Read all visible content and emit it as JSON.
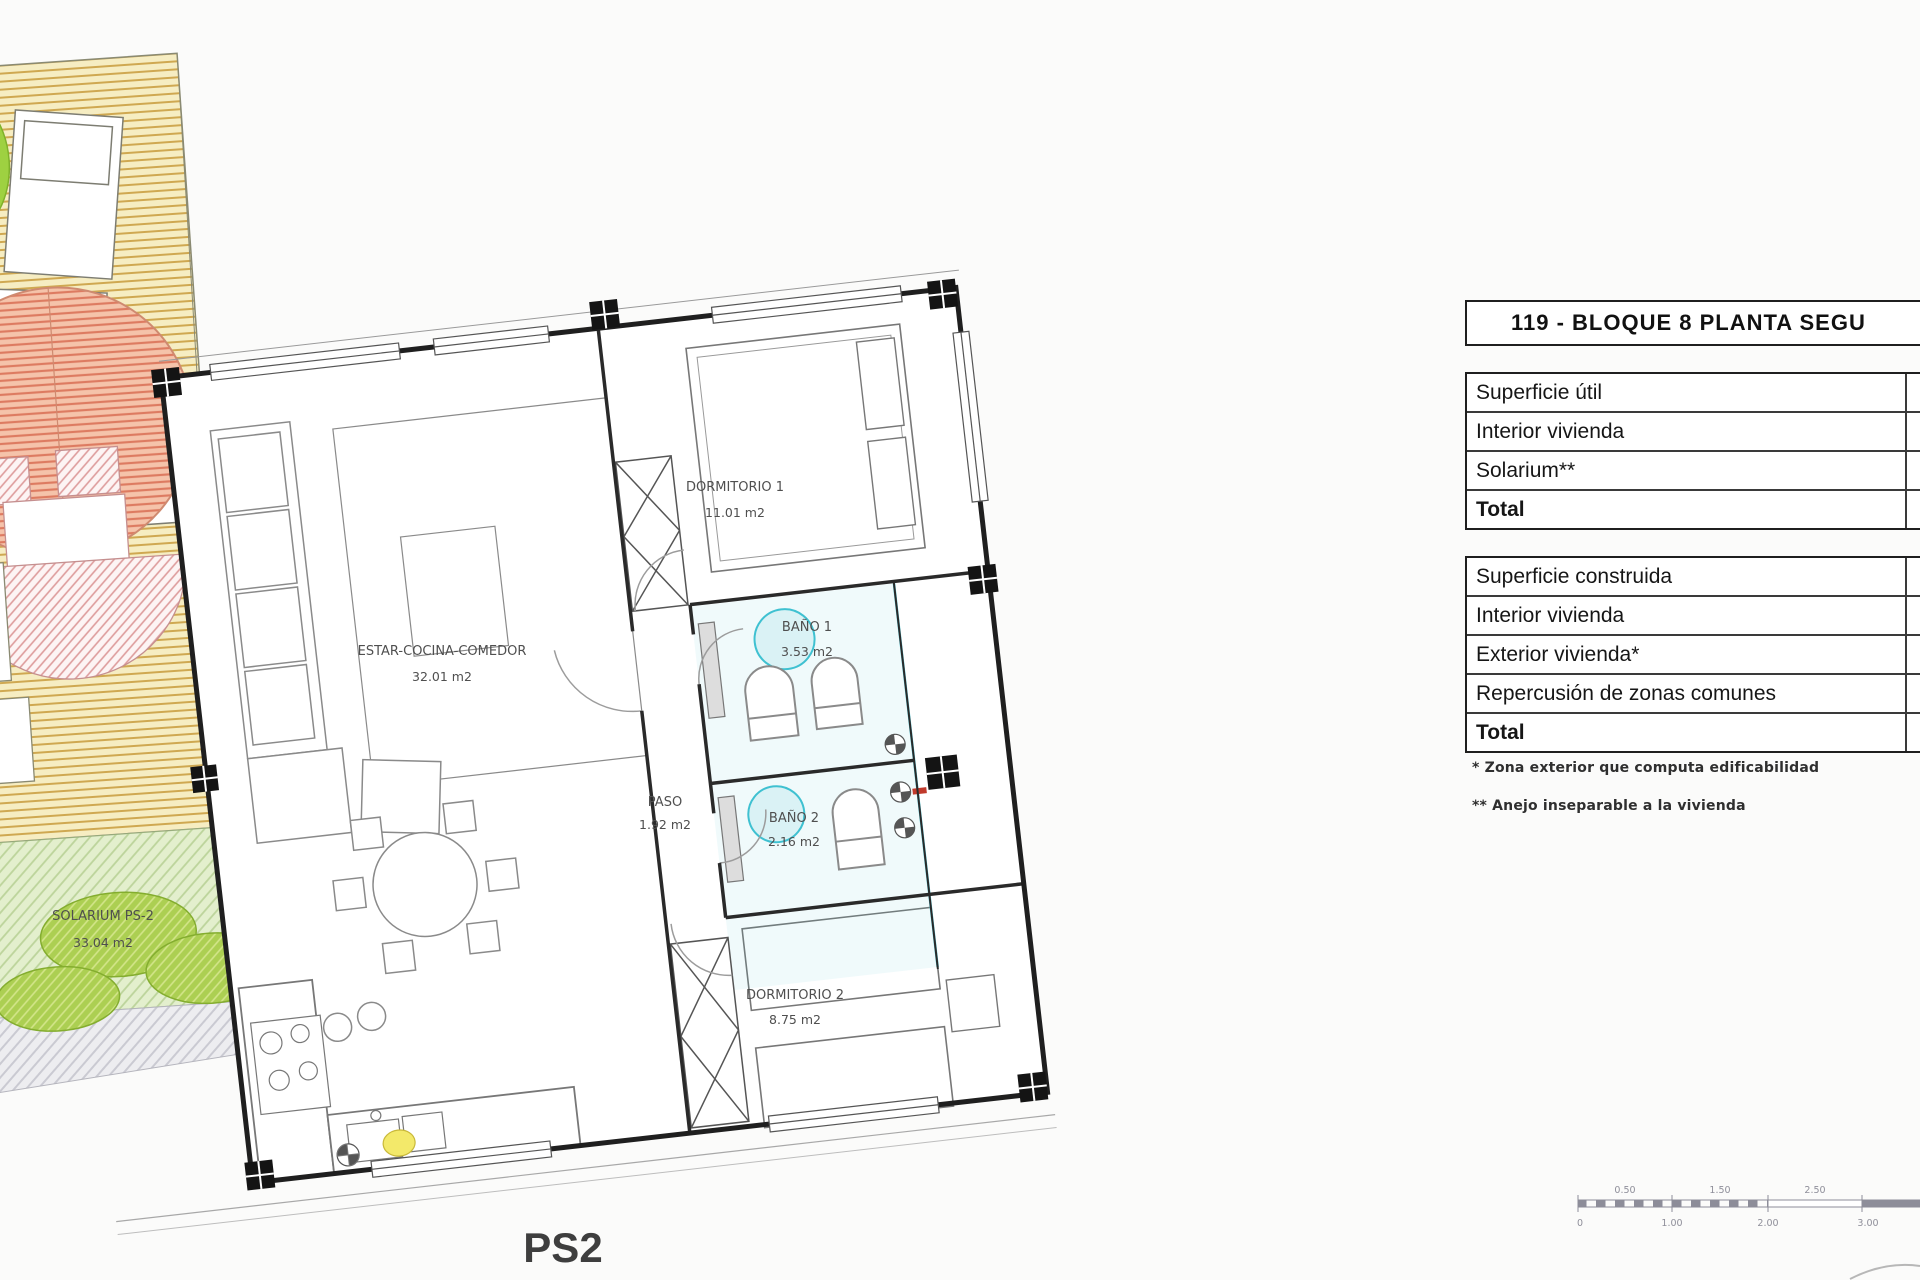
{
  "title": "119 - BLOQUE 8 PLANTA SEGU",
  "tables": {
    "util": {
      "header": "Superficie útil",
      "rows": [
        "Interior vivienda",
        "Solarium**",
        "Total"
      ]
    },
    "construida": {
      "header": "Superficie construida",
      "rows": [
        "Interior vivienda",
        "Exterior vivienda*",
        "Repercusión de zonas comunes",
        "Total"
      ]
    }
  },
  "footnotes": [
    "* Zona exterior que computa edificabilidad",
    "** Anejo inseparable a la vivienda"
  ],
  "plan": {
    "sheet_label": "PS2",
    "rooms": [
      {
        "name": "DORMITORIO 1",
        "area": "11.01 m2"
      },
      {
        "name": "BAÑO 1",
        "area": "3.53 m2"
      },
      {
        "name": "ESTAR-COCINA-COMEDOR",
        "area": "32.01 m2"
      },
      {
        "name": "PASO",
        "area": "1.92 m2"
      },
      {
        "name": "BAÑO 2",
        "area": "2.16 m2"
      },
      {
        "name": "DORMITORIO 2",
        "area": "8.75 m2"
      },
      {
        "name": "SOLARIUM PS-2",
        "area": "33.04 m2"
      }
    ]
  },
  "scale_bar": {
    "top_labels": [
      "0.50",
      "1.50",
      "2.50"
    ],
    "bottom_labels": [
      "0",
      "1.00",
      "2.00",
      "3.00"
    ]
  },
  "colors": {
    "wall": "#1f1f1f",
    "deck_hatch": "#cfa851",
    "parasol_hatch": "#dd7b61",
    "garden_green": "#accf52",
    "plumbing_cyan": "#3fc1d1",
    "boiler_yellow": "#f3e96a",
    "drain_red": "#c0392b"
  }
}
